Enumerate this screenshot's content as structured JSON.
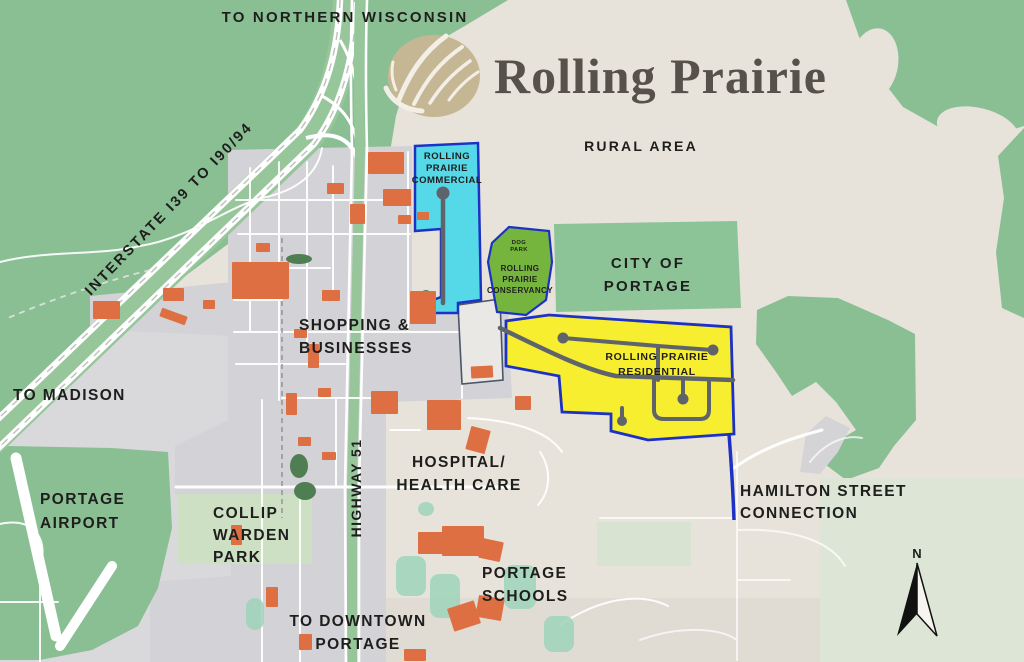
{
  "map": {
    "title": "Rolling Prairie",
    "labels": {
      "to_northern_wisconsin": "TO NORTHERN WISCONSIN",
      "rural_area": "RURAL AREA",
      "commercial_l1": "ROLLING",
      "commercial_l2": "PRAIRIE",
      "commercial_l3": "COMMERCIAL",
      "dog_park_l1": "DOG",
      "dog_park_l2": "PARK",
      "conservancy_l1": "ROLLING",
      "conservancy_l2": "PRAIRIE",
      "conservancy_l3": "CONSERVANCY",
      "city_of_portage_l1": "CITY OF",
      "city_of_portage_l2": "PORTAGE",
      "residential_l1": "ROLLING PRAIRIE",
      "residential_l2": "RESIDENTIAL",
      "shopping_l1": "SHOPPING &",
      "shopping_l2": "BUSINESSES",
      "interstate": "INTERSTATE I39 TO I90/94",
      "to_madison": "TO MADISON",
      "portage_airport_l1": "PORTAGE",
      "portage_airport_l2": "AIRPORT",
      "collip_l1": "COLLIP",
      "collip_l2": "WARDEN",
      "collip_l3": "PARK",
      "highway_51": "HIGHWAY 51",
      "hospital_l1": "HOSPITAL/",
      "hospital_l2": "HEALTH CARE",
      "portage_schools_l1": "PORTAGE",
      "portage_schools_l2": "SCHOOLS",
      "to_downtown_l1": "TO DOWNTOWN",
      "to_downtown_l2": "PORTAGE",
      "hamilton_l1": "HAMILTON STREET",
      "hamilton_l2": "CONNECTION",
      "compass_n": "N"
    },
    "colors": {
      "background_beige": "#e8e3da",
      "forest_green": "#8abf94",
      "conservancy_green": "#75b53e",
      "commercial_cyan": "#55d8e7",
      "residential_yellow": "#f6ee2e",
      "boundary_blue": "#1d32c4",
      "building_orange": "#dd6f43",
      "urban_gray": "#d3d2d6",
      "road_white": "#ffffff",
      "road_dark": "#5f646b",
      "park_light_green": "#cde0c4",
      "field_teal": "#9ed3b8",
      "title_gray": "#57514b",
      "logo_tan": "#c6b794",
      "label_black": "#1e1e1c"
    },
    "buildings": [
      [
        368,
        152,
        36,
        22,
        0
      ],
      [
        327,
        183,
        17,
        11,
        0
      ],
      [
        383,
        189,
        28,
        17,
        0
      ],
      [
        350,
        204,
        15,
        20,
        0
      ],
      [
        398,
        215,
        13,
        9,
        0
      ],
      [
        417,
        212,
        12,
        8,
        0
      ],
      [
        256,
        243,
        14,
        9,
        0
      ],
      [
        232,
        262,
        57,
        37,
        0
      ],
      [
        163,
        288,
        21,
        13,
        0
      ],
      [
        93,
        301,
        27,
        18,
        0
      ],
      [
        203,
        300,
        12,
        9,
        0
      ],
      [
        322,
        290,
        18,
        11,
        0
      ],
      [
        410,
        291,
        26,
        33,
        0
      ],
      [
        294,
        329,
        13,
        9,
        0
      ],
      [
        160,
        312,
        27,
        9,
        20
      ],
      [
        308,
        344,
        11,
        24,
        0
      ],
      [
        286,
        393,
        11,
        22,
        0
      ],
      [
        318,
        388,
        13,
        9,
        0
      ],
      [
        371,
        391,
        27,
        23,
        0
      ],
      [
        298,
        437,
        13,
        9,
        0
      ],
      [
        322,
        452,
        14,
        8,
        0
      ],
      [
        427,
        400,
        34,
        30,
        0
      ],
      [
        468,
        428,
        20,
        24,
        15
      ],
      [
        515,
        396,
        16,
        14,
        0
      ],
      [
        471,
        366,
        22,
        12,
        -3
      ],
      [
        418,
        532,
        26,
        22,
        0
      ],
      [
        442,
        526,
        42,
        30,
        0
      ],
      [
        480,
        540,
        22,
        20,
        12
      ],
      [
        450,
        604,
        28,
        24,
        -18
      ],
      [
        477,
        597,
        26,
        22,
        10
      ],
      [
        404,
        649,
        22,
        12,
        0
      ],
      [
        231,
        525,
        11,
        20,
        0
      ],
      [
        266,
        587,
        12,
        20,
        0
      ],
      [
        299,
        634,
        13,
        16,
        0
      ]
    ],
    "trees": [
      [
        426,
        305,
        9,
        15
      ],
      [
        299,
        466,
        9,
        12
      ],
      [
        305,
        491,
        11,
        9
      ],
      [
        299,
        259,
        13,
        5
      ]
    ],
    "sports_fields": [
      [
        396,
        556,
        30,
        40
      ],
      [
        430,
        574,
        30,
        44
      ],
      [
        504,
        565,
        32,
        44
      ],
      [
        544,
        616,
        30,
        36
      ],
      [
        418,
        502,
        16,
        14
      ],
      [
        246,
        598,
        18,
        32
      ]
    ]
  }
}
